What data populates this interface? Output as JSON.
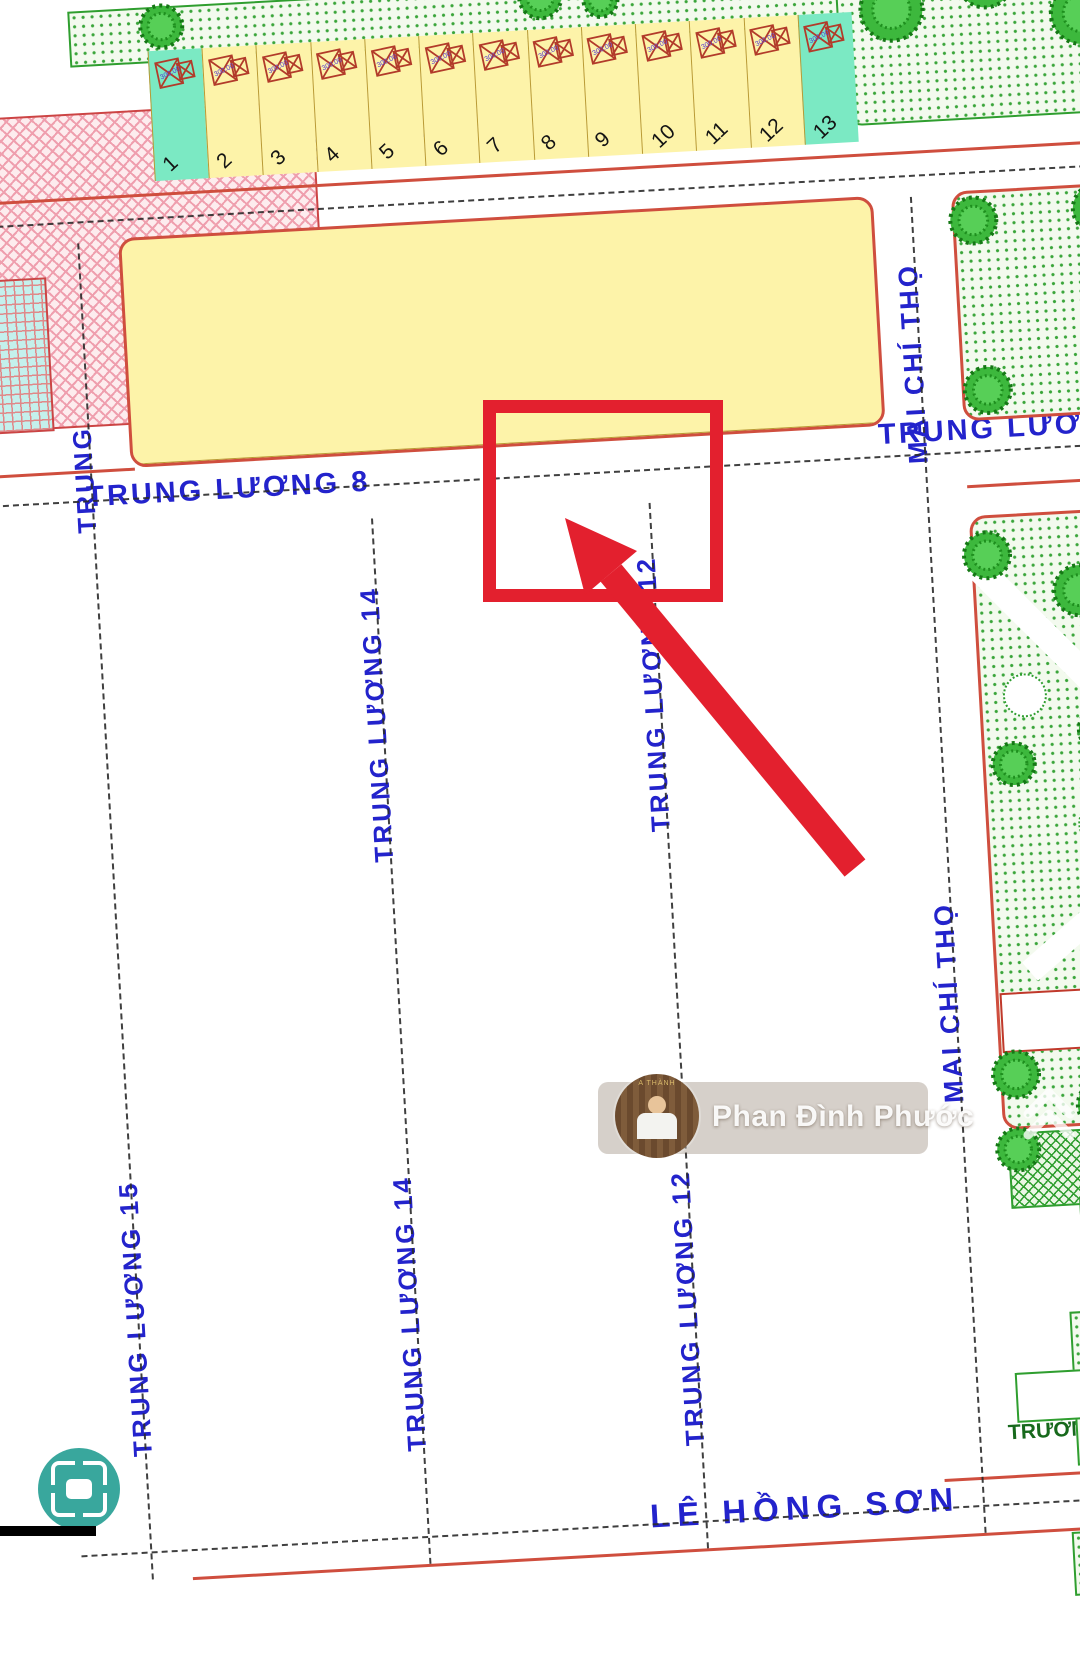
{
  "map": {
    "streets": {
      "nguyen_dinh_thi": "NGUYỄN ĐÌNH THI",
      "trung_luong_8": "TRUNG LƯƠNG 8",
      "trung_luong": "TRUNG LƯƠNG",
      "trung_luong_15": "TRUNG LƯƠNG 15",
      "trung_luong_14": "TRUNG LƯƠNG 14",
      "trung_luong_12": "TRUNG LƯƠNG 12",
      "mai_chi_tho": "MAI CHÍ THỌ",
      "le_hong_son": "LÊ HỒNG SƠN"
    },
    "school_label": "TRƯỜNG MẪ",
    "stamps": [
      {
        "id": "B2-7",
        "area": "3.900",
        "count": "13"
      },
      {
        "id": "B2-6",
        "area": "7.543",
        "count": "30"
      },
      {
        "id": "B1-16",
        "area": "",
        "count": "88"
      },
      {
        "id": "B1-15",
        "area": "8.658",
        "count": "84"
      },
      {
        "id": "B1-14",
        "area": "8.658",
        "count": "84"
      },
      {
        "id": "B1-13",
        "area": "8.658",
        "count": "84"
      },
      {
        "id": "A6-2",
        "area": "310",
        "count": "1"
      },
      {
        "id": "A5-4-2",
        "area": "4.006",
        "count": "1",
        "sub_left": "40",
        "sub_right": "3"
      }
    ],
    "b27_row": {
      "plots": [
        1,
        2,
        3,
        4,
        5,
        6,
        7,
        8,
        9,
        10,
        11,
        12,
        13
      ],
      "green": [
        1,
        13
      ],
      "house_len": "300.00"
    },
    "b26": {
      "top_row": [
        30,
        29,
        28,
        27,
        26,
        25,
        24,
        23,
        22,
        21,
        20,
        19,
        18,
        17,
        16
      ],
      "bottom_row": [
        1,
        2,
        3,
        4,
        5,
        6,
        7,
        8,
        9,
        10,
        11,
        12,
        13,
        14,
        15
      ],
      "green_top": [
        30,
        16
      ],
      "green_bottom": [
        1,
        15
      ],
      "lavender_bottom": [
        5,
        6,
        10,
        11
      ],
      "house_len": "249.75"
    },
    "main_blocks": [
      {
        "name": "B1-16",
        "left": {
          "top": null,
          "start": 45,
          "end": 87,
          "bottom": 88
        },
        "right": {
          "top": null,
          "start": 44,
          "end": 2,
          "bottom": 1
        }
      },
      {
        "name": "B1-15",
        "left": {
          "top": 43,
          "start": 44,
          "end": 83,
          "bottom": 84
        },
        "right": {
          "top": 42,
          "start": 41,
          "end": 2,
          "bottom": 1
        }
      },
      {
        "name": "B1-14",
        "left": {
          "top": 43,
          "start": 44,
          "end": 83,
          "bottom": 84
        },
        "right": {
          "top": 42,
          "start": 41,
          "end": 2,
          "bottom": 1
        }
      },
      {
        "name": "B1-13",
        "left": {
          "top": 43,
          "start": 44,
          "end": 83,
          "bottom": 84
        },
        "right": {
          "top": 42,
          "start": 41,
          "end": 2,
          "bottom": 1
        }
      }
    ],
    "plot_len": "100.00",
    "cyan_len_top": "154.80",
    "cyan_len_bottom": "174.60",
    "markers": [
      {
        "t": "4",
        "x": 398,
        "y": 36
      },
      {
        "t": "4",
        "x": 655,
        "y": 222
      },
      {
        "t": "4",
        "x": 440,
        "y": 520
      },
      {
        "t": "11",
        "x": 735,
        "y": 930,
        "rot": -85
      },
      {
        "t": "5",
        "x": 18,
        "y": 1505
      }
    ],
    "watermark": {
      "name": "Phan Đình Phước",
      "avatar_text": "A THÀNH"
    },
    "colors": {
      "annotation_red": "#e3202e",
      "street_edge_red": "#cf4e3e",
      "plot_yellow": "#fdf3a9",
      "strip_cyan": "#3ee3ea",
      "plot_green": "#7be9c3",
      "plot_lavender": "#dcd2f4",
      "label_blue": "#2323cc",
      "park_green": "#3aa53a",
      "house_stroke": "#b23b2a"
    }
  }
}
